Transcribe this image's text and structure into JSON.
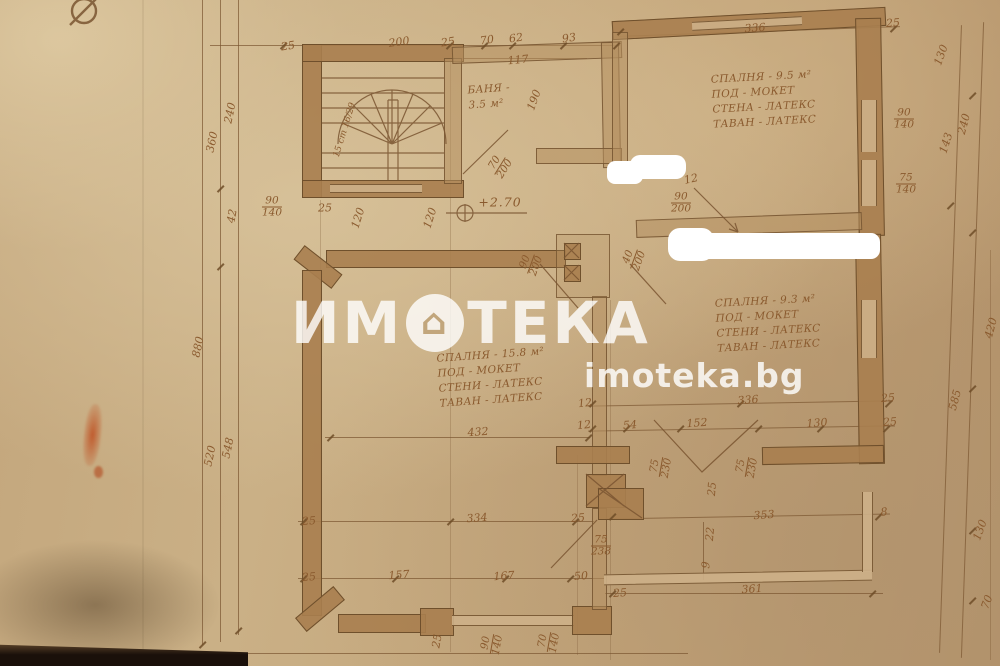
{
  "watermark": {
    "brand_left": "ИМ",
    "brand_right": "ТЕКА",
    "house_glyph": "⌂",
    "site": "imoteka.bg"
  },
  "rooms": [
    {
      "id": "bedroom-9-5",
      "x": 712,
      "y": 70,
      "rot": -3,
      "lines": [
        "СПАЛНЯ - 9.5 м²",
        "ПОД  -  МОКЕТ",
        "СТЕНА - ЛАТЕКС",
        "ТАВАН - ЛАТЕКС"
      ]
    },
    {
      "id": "bedroom-9-3",
      "x": 716,
      "y": 294,
      "rot": -3,
      "lines": [
        "СПАЛНЯ - 9.3 м²",
        "ПОД -   МОКЕТ",
        "СТЕНИ - ЛАТЕКС",
        "ТАВАН - ЛАТЕКС"
      ]
    },
    {
      "id": "bedroom-15-8",
      "x": 438,
      "y": 348,
      "rot": -4,
      "lines": [
        "СПАЛНЯ - 15.8 м²",
        "ПОД  -  МОКЕТ",
        "СТЕНИ - ЛАТЕКС",
        "ТАВАН - ЛАТЕКС"
      ]
    },
    {
      "id": "bath",
      "x": 468,
      "y": 82,
      "rot": -4,
      "lines": [
        "БАНЯ -",
        "3.5 м²"
      ]
    }
  ],
  "dim_labels": [
    {
      "t": "25",
      "x": 288,
      "y": 46,
      "r": -8
    },
    {
      "t": "200",
      "x": 399,
      "y": 42,
      "r": -8
    },
    {
      "t": "25",
      "x": 448,
      "y": 42,
      "r": -8
    },
    {
      "t": "70",
      "x": 487,
      "y": 40,
      "r": -8
    },
    {
      "t": "62",
      "x": 516,
      "y": 38,
      "r": -8
    },
    {
      "t": "93",
      "x": 569,
      "y": 38,
      "r": -8
    },
    {
      "t": "117",
      "x": 518,
      "y": 60,
      "r": -5
    },
    {
      "t": "336",
      "x": 755,
      "y": 28,
      "r": -4
    },
    {
      "t": "25",
      "x": 893,
      "y": 23,
      "r": -4
    },
    {
      "t": "240",
      "x": 230,
      "y": 113,
      "r": -78
    },
    {
      "t": "360",
      "x": 212,
      "y": 142,
      "r": -78
    },
    {
      "t": "42",
      "x": 232,
      "y": 216,
      "r": -80
    },
    {
      "t": "880",
      "x": 198,
      "y": 347,
      "r": -78
    },
    {
      "t": "520",
      "x": 210,
      "y": 456,
      "r": -78
    },
    {
      "t": "548",
      "x": 228,
      "y": 448,
      "r": -78
    },
    {
      "t": "90/140",
      "x": 272,
      "y": 207,
      "r": 0
    },
    {
      "t": "130",
      "x": 941,
      "y": 55,
      "r": -70
    },
    {
      "t": "90/140",
      "x": 904,
      "y": 119,
      "r": 0
    },
    {
      "t": "240",
      "x": 964,
      "y": 124,
      "r": -75
    },
    {
      "t": "143",
      "x": 946,
      "y": 143,
      "r": -72
    },
    {
      "t": "75/140",
      "x": 906,
      "y": 184,
      "r": 0
    },
    {
      "t": "420",
      "x": 991,
      "y": 328,
      "r": -75
    },
    {
      "t": "585",
      "x": 955,
      "y": 400,
      "r": -75
    },
    {
      "t": "130",
      "x": 980,
      "y": 530,
      "r": -70
    },
    {
      "t": "70",
      "x": 987,
      "y": 602,
      "r": -70
    },
    {
      "t": "190",
      "x": 534,
      "y": 100,
      "r": -70
    },
    {
      "t": "15 ст 16/29",
      "x": 345,
      "y": 130,
      "r": -73,
      "cls": "small",
      "name": "stair-note"
    },
    {
      "t": "25",
      "x": 325,
      "y": 208,
      "r": 0
    },
    {
      "t": "120",
      "x": 358,
      "y": 218,
      "r": -72
    },
    {
      "t": "120",
      "x": 430,
      "y": 218,
      "r": -72
    },
    {
      "t": "70/200",
      "x": 500,
      "y": 166,
      "r": -58
    },
    {
      "t": "+2.70",
      "x": 500,
      "y": 202,
      "r": 0,
      "cls": "level",
      "name": "level-mark"
    },
    {
      "t": "12",
      "x": 691,
      "y": 179,
      "r": -12
    },
    {
      "t": "90/200",
      "x": 681,
      "y": 203,
      "r": 0
    },
    {
      "t": "90/200",
      "x": 531,
      "y": 264,
      "r": -70
    },
    {
      "t": "40/200",
      "x": 634,
      "y": 259,
      "r": -70
    },
    {
      "t": "432",
      "x": 478,
      "y": 432,
      "r": -4
    },
    {
      "t": "12",
      "x": 585,
      "y": 403,
      "r": -6
    },
    {
      "t": "12",
      "x": 584,
      "y": 425,
      "r": -6
    },
    {
      "t": "336",
      "x": 748,
      "y": 400,
      "r": -4
    },
    {
      "t": "25",
      "x": 888,
      "y": 398,
      "r": -4
    },
    {
      "t": "54",
      "x": 630,
      "y": 425,
      "r": -4
    },
    {
      "t": "152",
      "x": 697,
      "y": 423,
      "r": -4
    },
    {
      "t": "130",
      "x": 817,
      "y": 423,
      "r": -4
    },
    {
      "t": "25",
      "x": 890,
      "y": 422,
      "r": -4
    },
    {
      "t": "75/230",
      "x": 661,
      "y": 467,
      "r": -80
    },
    {
      "t": "75/230",
      "x": 747,
      "y": 467,
      "r": -80
    },
    {
      "t": "25",
      "x": 712,
      "y": 489,
      "r": -85
    },
    {
      "t": "25",
      "x": 309,
      "y": 521,
      "r": -4
    },
    {
      "t": "334",
      "x": 477,
      "y": 518,
      "r": -4
    },
    {
      "t": "25",
      "x": 578,
      "y": 518,
      "r": -4
    },
    {
      "t": "75/238",
      "x": 601,
      "y": 546,
      "r": 0
    },
    {
      "t": "25",
      "x": 309,
      "y": 577,
      "r": -4
    },
    {
      "t": "157",
      "x": 399,
      "y": 575,
      "r": -4
    },
    {
      "t": "167",
      "x": 504,
      "y": 576,
      "r": -4
    },
    {
      "t": "50",
      "x": 581,
      "y": 576,
      "r": -4
    },
    {
      "t": "353",
      "x": 764,
      "y": 515,
      "r": -4
    },
    {
      "t": "8",
      "x": 884,
      "y": 512,
      "r": -4
    },
    {
      "t": "22",
      "x": 710,
      "y": 534,
      "r": -85
    },
    {
      "t": "9",
      "x": 706,
      "y": 565,
      "r": -85
    },
    {
      "t": "361",
      "x": 752,
      "y": 589,
      "r": -4
    },
    {
      "t": "25",
      "x": 620,
      "y": 593,
      "r": -4
    },
    {
      "t": "25",
      "x": 437,
      "y": 641,
      "r": -80
    },
    {
      "t": "90/140",
      "x": 492,
      "y": 644,
      "r": -80
    },
    {
      "t": "70/140",
      "x": 549,
      "y": 642,
      "r": -80
    }
  ]
}
